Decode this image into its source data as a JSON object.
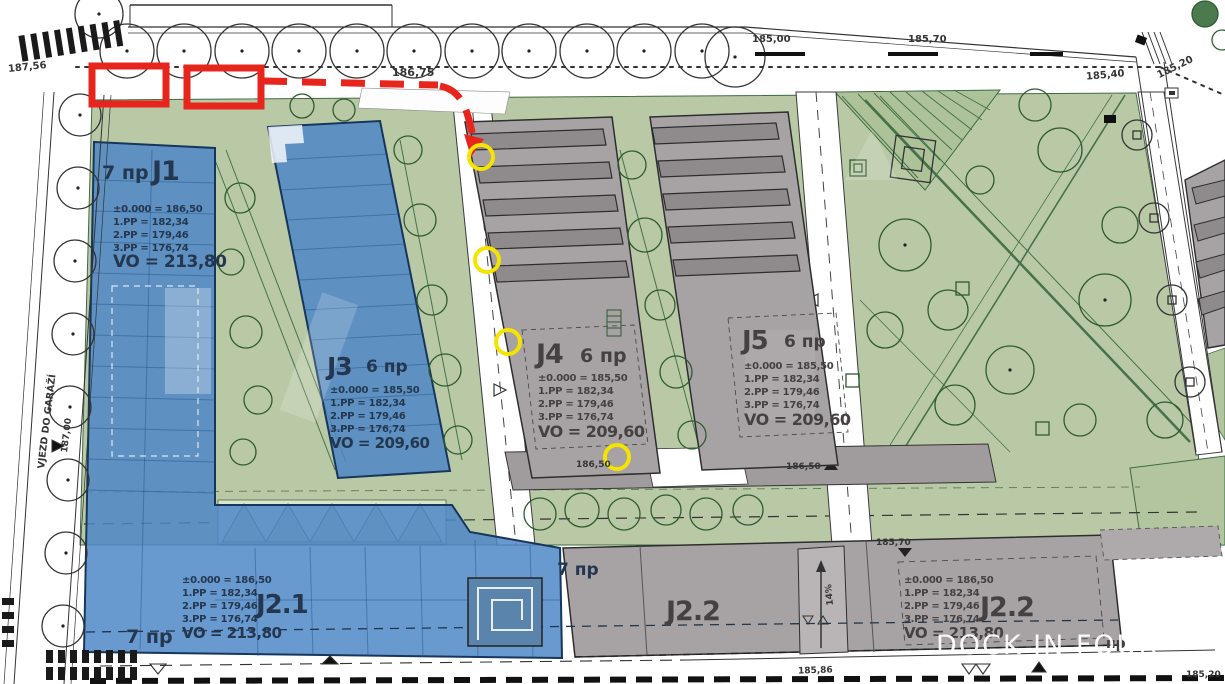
{
  "buildings": [
    {
      "id": "J1",
      "floors": "7 пр",
      "lines": [
        "±0.000 = 186,50",
        "1.PP = 182,34",
        "2.PP = 179,46",
        "3.PP = 176,74"
      ],
      "vo": "VO = 213,80"
    },
    {
      "id": "J3",
      "floors": "6 пр",
      "lines": [
        "±0.000 = 185,50",
        "1.PP = 182,34",
        "2.PP = 179,46",
        "3.PP = 176,74"
      ],
      "vo": "VO = 209,60"
    },
    {
      "id": "J4",
      "floors": "6 пр",
      "lines": [
        "±0.000 = 185,50",
        "1.PP = 182,34",
        "2.PP = 179,46",
        "3.PP = 176,74"
      ],
      "vo": "VO = 209,60"
    },
    {
      "id": "J5",
      "floors": "6 пр",
      "lines": [
        "±0.000 = 185,50",
        "1.PP = 182,34",
        "2.PP = 179,46",
        "3.PP = 176,74"
      ],
      "vo": "VO = 209,60"
    },
    {
      "id": "J2.1",
      "floors_top": "7 пр",
      "floors_bottom": "7 пр",
      "lines": [
        "±0.000 = 186,50",
        "1.PP = 182,34",
        "2.PP = 179,46",
        "3.PP = 176,74"
      ],
      "vo": "VO = 213,80"
    },
    {
      "id": "J2.2"
    },
    {
      "id": "J2.2",
      "lines": [
        "±0.000 = 186,50",
        "1.PP = 182,34",
        "2.PP = 179,46",
        "3.PP = 176,74"
      ],
      "vo": "VO = 213,80"
    }
  ],
  "levels": {
    "v187_56": "187,56",
    "v186_75": "186,75",
    "v185_00": "185,00",
    "v185_70": "185,70",
    "v185_40": "185,40",
    "v185_20": "185,20",
    "v187_00": "187,00",
    "v186_50_a": "186,50",
    "v186_50_b": "186,50",
    "v185_70_b": "185,70",
    "v185_86": "185,86",
    "v185_20_b": "185,20"
  },
  "side_labels": {
    "garage": "VJEZD DO GARÁŽÍ",
    "ramp": "14%",
    "np_right": "пр"
  },
  "annotations": {
    "watermark": "DOCK IN FOUR"
  },
  "palette": {
    "highlight_blue": "#4e87c7",
    "building_gray": "#a7a3a4",
    "landscape_green": "#b9c9a6",
    "annotation_red": "#e8251d",
    "annotation_yellow": "#f5e400"
  }
}
